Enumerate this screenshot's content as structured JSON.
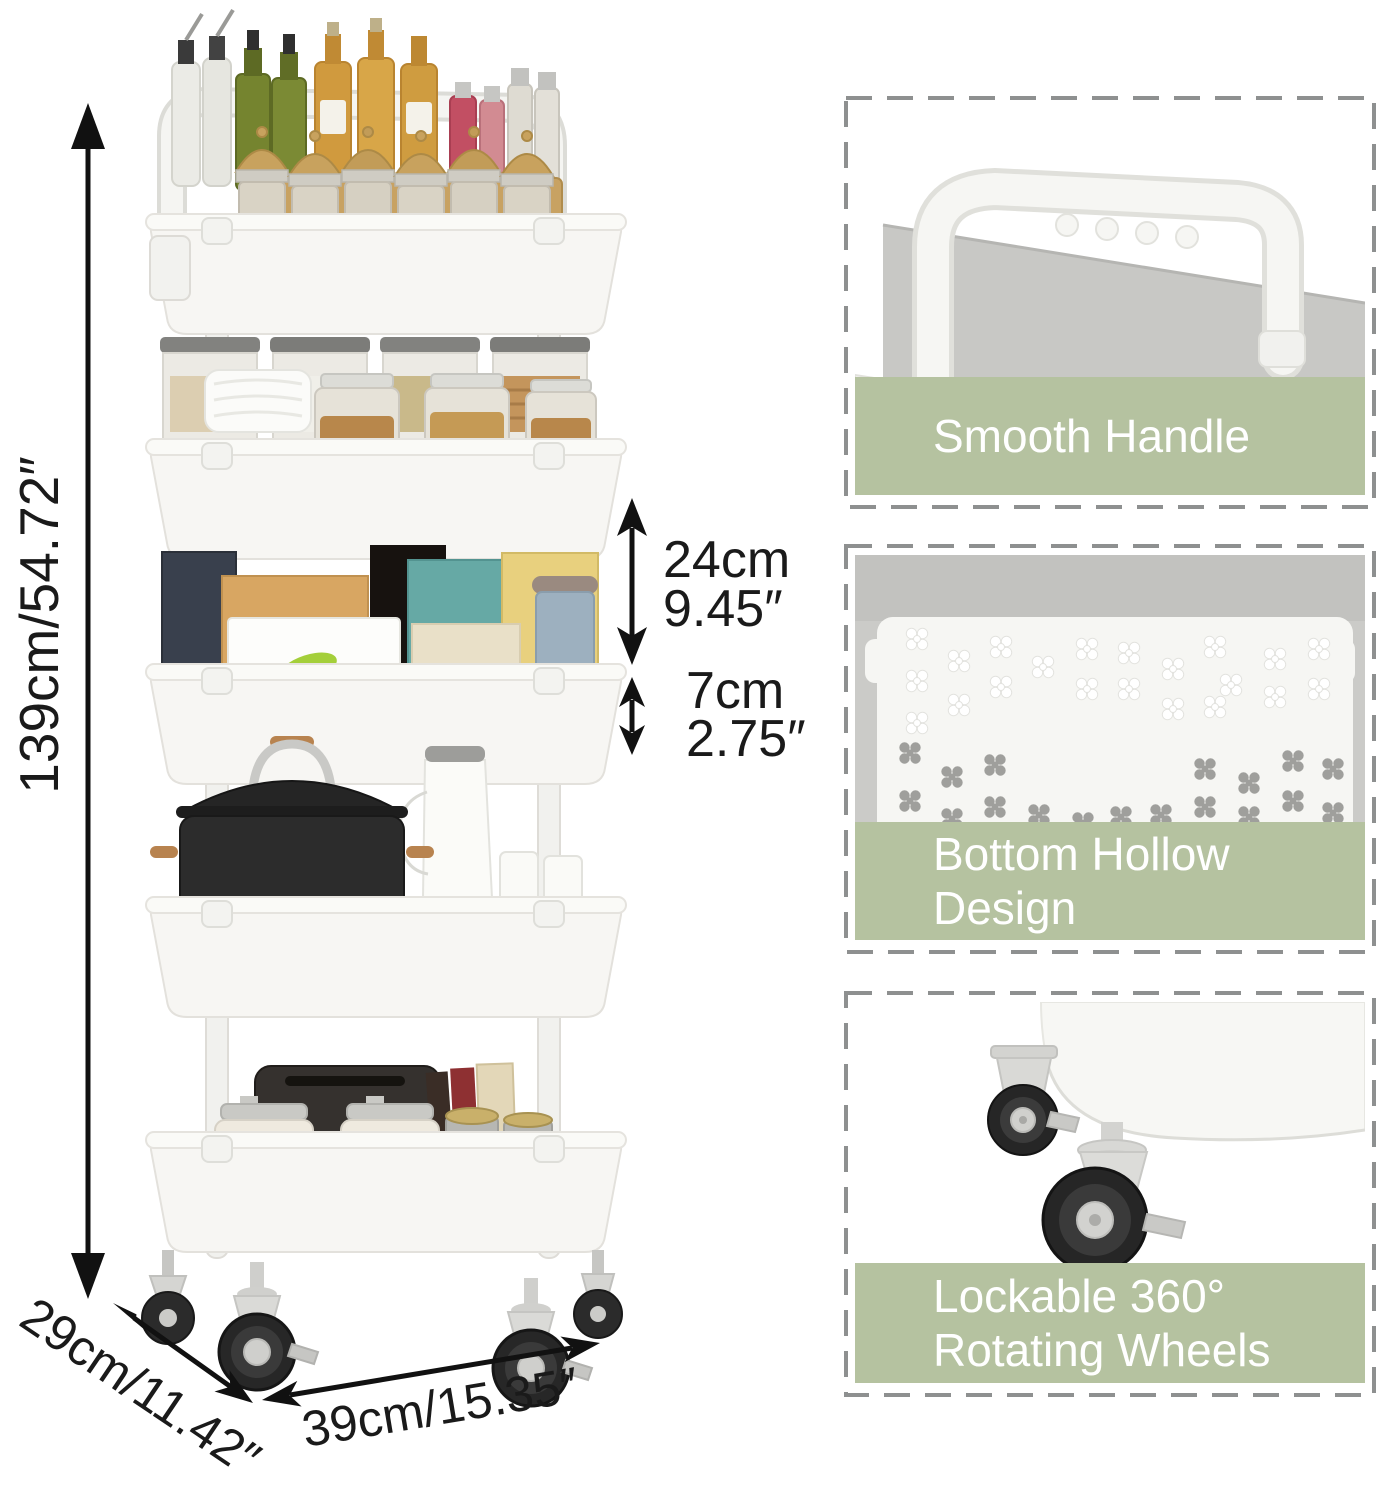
{
  "image_alt": "White 5-tier rolling utility cart filled with kitchen items, shown with dimension arrows and three feature close-up panels",
  "dimension_labels": {
    "height": "139cm/54.72″",
    "tier_gap_cm": "24cm",
    "tier_gap_in": "9.45″",
    "basket_depth_cm": "7cm",
    "basket_depth_in": "2.75″",
    "depth": "29cm/11.42″",
    "width": "39cm/15.35″"
  },
  "feature_panels": [
    {
      "name": "smooth-handle",
      "caption_lines": [
        "Smooth Handle"
      ]
    },
    {
      "name": "bottom-hollow-design",
      "caption_lines": [
        "Bottom Hollow",
        "Design"
      ]
    },
    {
      "name": "lockable-wheels",
      "caption_lines": [
        "Lockable 360°",
        "Rotating Wheels"
      ]
    }
  ],
  "colors": {
    "caption_band": "#b5c2a0",
    "caption_text": "#ffffff",
    "dashed_border": "#8e9090",
    "dimension_text": "#1a1a1a",
    "arrow": "#111111",
    "cart_white": "#f6f5f2"
  }
}
